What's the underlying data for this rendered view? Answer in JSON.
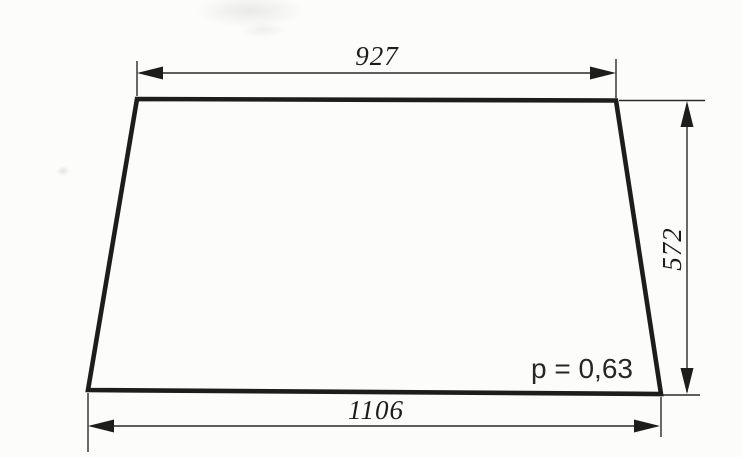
{
  "drawing": {
    "shape": "trapezoid-panel",
    "annotation": "p = 0,63"
  },
  "dimensions": {
    "top_width": "927",
    "bottom_width": "1106",
    "side_height": "572"
  },
  "colors": {
    "ink": "#1d1d1d",
    "paper": "#fcfcfb"
  }
}
